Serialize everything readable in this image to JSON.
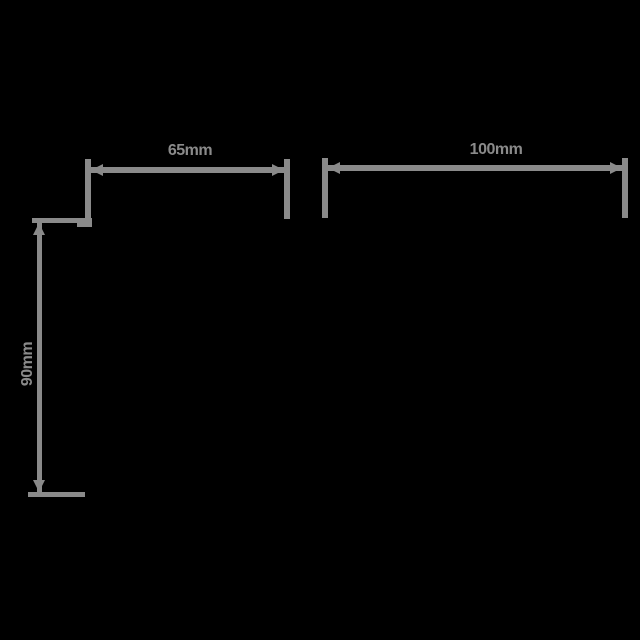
{
  "drawing": {
    "background_color": "#000000",
    "line_color": "#8a8a8a",
    "dimensions": {
      "top_left": {
        "label": "65mm"
      },
      "top_right": {
        "label": "100mm"
      },
      "left_vertical": {
        "label": "90mm"
      }
    }
  }
}
